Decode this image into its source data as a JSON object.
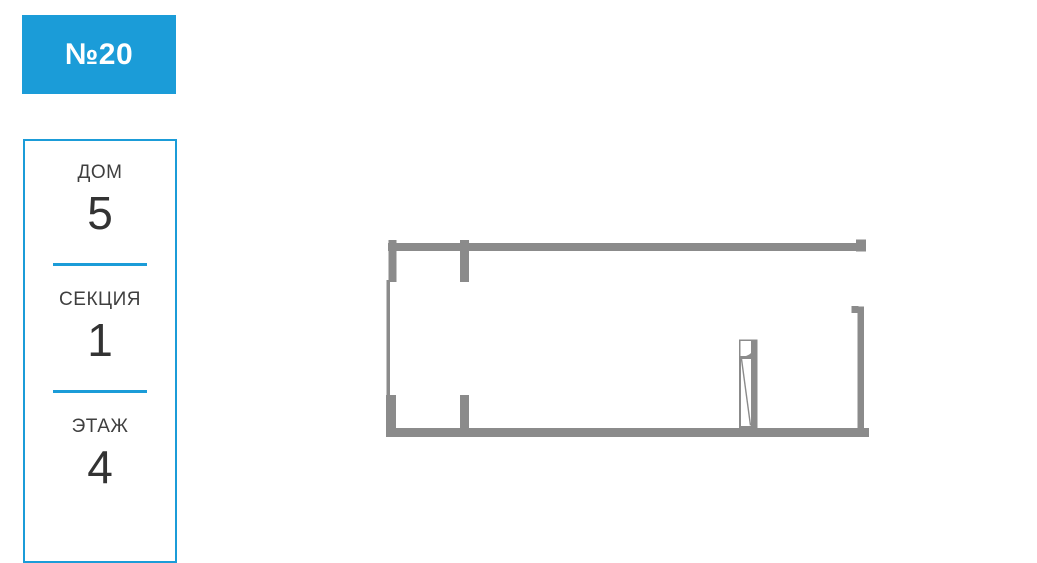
{
  "unit": {
    "number_label": "№20"
  },
  "card": {
    "fields": [
      {
        "label": "ДОМ",
        "value": "5"
      },
      {
        "label": "СЕКЦИЯ",
        "value": "1"
      },
      {
        "label": "ЭТАЖ",
        "value": "4"
      }
    ]
  },
  "colors": {
    "accent_blue": "#1b9cd8",
    "wall_gray": "#8b8b8b",
    "label_text": "#3f3f3f",
    "value_text": "#333333",
    "badge_text": "#ffffff"
  },
  "floorplan": {
    "description": "single-room apartment plan, top view, gray walls, window on left wall, wall openings top-left and right, interior door near bottom-right",
    "shapes": [
      {
        "name": "wall-top",
        "type": "rect",
        "x": 388,
        "y": 243,
        "w": 478,
        "h": 8
      },
      {
        "name": "wall-stub-top-left",
        "type": "rect",
        "x": 388.5,
        "y": 240,
        "w": 8,
        "h": 42
      },
      {
        "name": "wall-stub-top-middle",
        "type": "rect",
        "x": 460,
        "y": 240,
        "w": 9,
        "h": 42
      },
      {
        "name": "wall-cap-top-right",
        "type": "rect",
        "x": 856,
        "y": 239.5,
        "w": 10,
        "h": 12
      },
      {
        "name": "wall-left-window",
        "type": "rect",
        "x": 386.5,
        "y": 280,
        "w": 3.5,
        "h": 117
      },
      {
        "name": "wall-stub-bottom-left",
        "type": "rect",
        "x": 386,
        "y": 395,
        "w": 10,
        "h": 42
      },
      {
        "name": "wall-bottom",
        "type": "rect",
        "x": 388,
        "y": 428,
        "w": 481,
        "h": 9
      },
      {
        "name": "wall-stub-bottom-middle",
        "type": "rect",
        "x": 460,
        "y": 395,
        "w": 9,
        "h": 35
      },
      {
        "name": "wall-right",
        "type": "rect",
        "x": 857.5,
        "y": 306.5,
        "w": 6.5,
        "h": 130
      },
      {
        "name": "wall-tick-right-top",
        "type": "rect",
        "x": 851.5,
        "y": 306,
        "w": 7,
        "h": 7
      },
      {
        "name": "door-frame",
        "type": "rect",
        "x": 740,
        "y": 340.5,
        "w": 16.5,
        "h": 86.5,
        "fill": "#ffffff",
        "stroke": "wall",
        "sw": 2
      },
      {
        "name": "door-swing-fill",
        "type": "rect",
        "x": 740.5,
        "y": 341,
        "w": 16,
        "h": 16.5,
        "fill": "wall"
      },
      {
        "name": "door-swing-arc",
        "type": "path",
        "d": "M740.5,341 L756.5,341 A16,16 0 0 1 740.5,357 Z",
        "fill": "#ffffff"
      },
      {
        "name": "door-lintel",
        "type": "rect",
        "x": 740.5,
        "y": 356,
        "w": 16,
        "h": 3,
        "fill": "wall"
      },
      {
        "name": "door-leaf",
        "type": "rect",
        "x": 751,
        "y": 341,
        "w": 5.5,
        "h": 86,
        "fill": "wall"
      },
      {
        "name": "door-diagonal",
        "type": "line",
        "x1": 741.5,
        "y1": 359,
        "x2": 750.5,
        "y2": 425.5,
        "stroke": "wall",
        "sw": 1.4
      }
    ]
  }
}
